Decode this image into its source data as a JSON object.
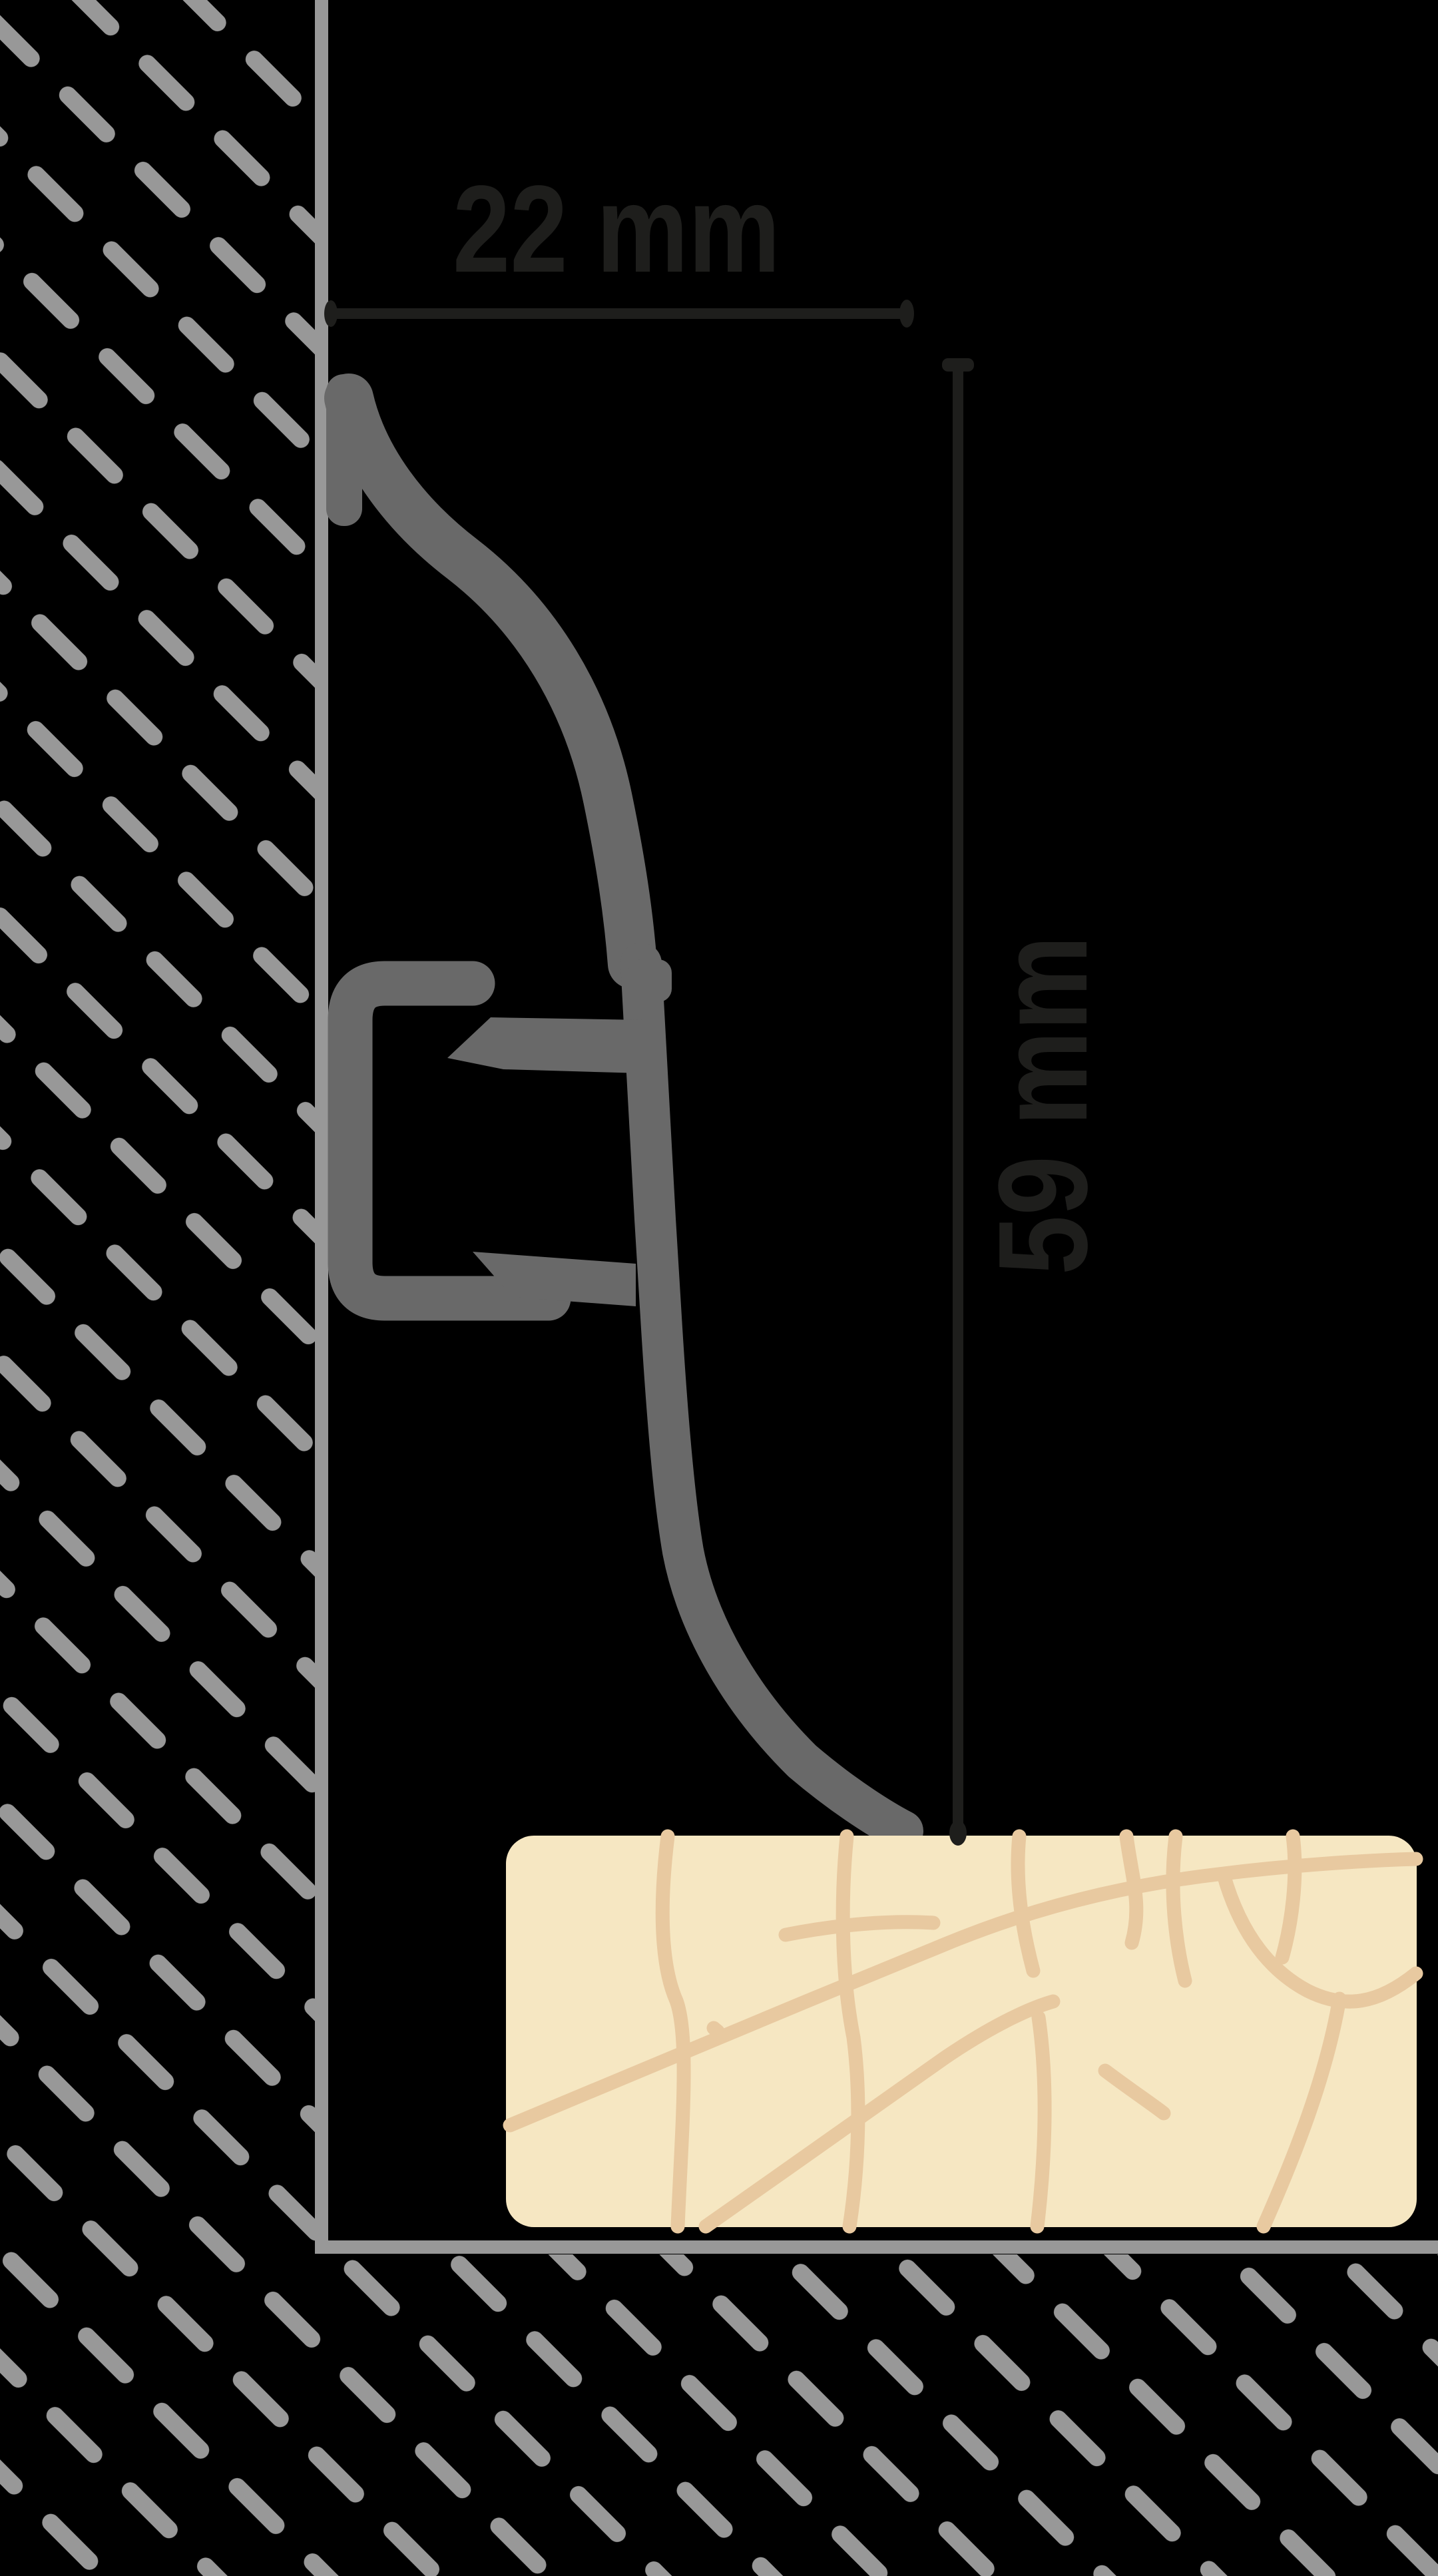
{
  "diagram": {
    "title": "skirting-board-profile-cross-section",
    "dimensions": {
      "width": {
        "label": "22 mm",
        "value": 22,
        "unit": "mm"
      },
      "height": {
        "label": "59 mm",
        "value": 59,
        "unit": "mm"
      }
    },
    "colors": {
      "background": "#000000",
      "hatch": "#989898",
      "wall_line": "#989898",
      "profile": "#696969",
      "dimension": "#1e1e1c",
      "floor": "#f6e7c2",
      "floor_grain": "#e8c9a0"
    },
    "icons": {
      "wall_hatch": "diagonal-dash-hatch",
      "profile": "skirting-profile-silhouette",
      "floor": "wood-floor-panel"
    }
  }
}
